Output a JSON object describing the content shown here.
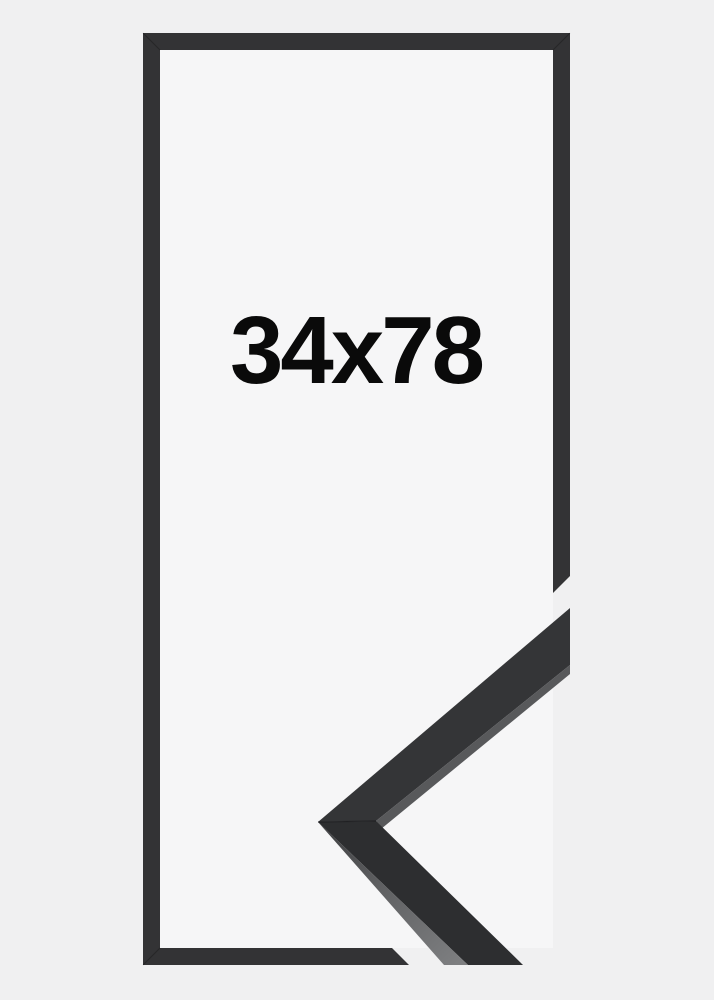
{
  "product": {
    "size_label": "34x78",
    "colors": {
      "page_background": "#f0f0f1",
      "inner_background": "#f6f6f7",
      "frame": "#333335",
      "sample_face_upper": "#343537",
      "sample_face_lower": "#2d2e30",
      "sample_bevel": "#58595b",
      "label_text": "#0a0a0a"
    }
  }
}
